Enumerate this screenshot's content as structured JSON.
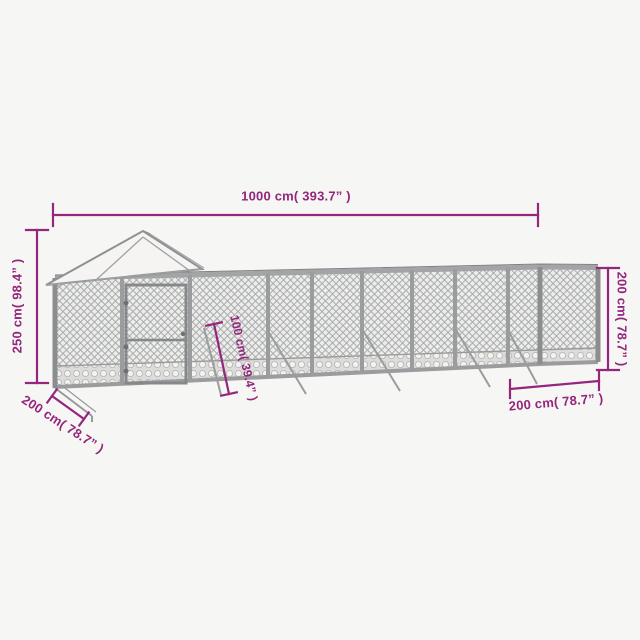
{
  "product_diagram": {
    "dimensions": {
      "length_top": "1000 cm( 393.7” )",
      "height_left": "250 cm( 98.4” )",
      "wall_height_right": "200 cm( 78.7” )",
      "depth_bottom_left": "200 cm( 78.7” )",
      "brace_length": "100 cm( 39.4” )",
      "depth_bottom_right": "200 cm( 78.7” )"
    },
    "colors": {
      "dimension_accent": "#94267d",
      "background": "#f6f6f4",
      "frame_gray": "#8f9092",
      "mesh_gray": "#a6a9ab",
      "roof_white": "#f5f4f2"
    }
  }
}
